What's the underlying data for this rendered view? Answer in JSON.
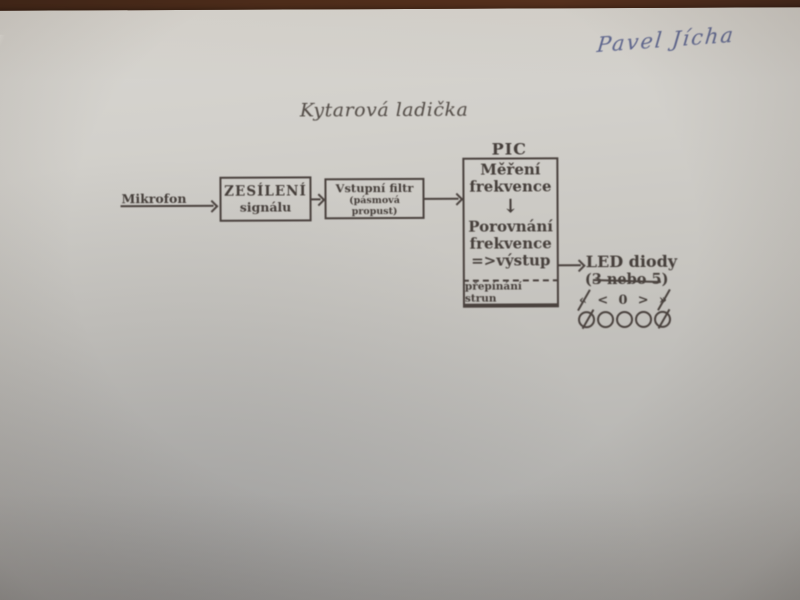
{
  "photo": {
    "handwriting": "Pavel Jícha",
    "title": "Kytarová ladička"
  },
  "diagram": {
    "mikrofon_label": "Mikrofon",
    "amp_box": {
      "line1": "ZESÍLENÍ",
      "line2": "signálu"
    },
    "filter_box": {
      "line1": "Vstupní filtr",
      "line2": "(pásmová propust)"
    },
    "pic": {
      "label": "PIC",
      "step1_line1": "Měření",
      "step1_line2": "frekvence",
      "flow_arrow": "↓",
      "step2_line1": "Porovnání",
      "step2_line2": "frekvence",
      "step2_line3": "=>výstup",
      "footer": "přepínání strun"
    },
    "led": {
      "title": "LED diody",
      "subtitle": "(3 nebo 5)",
      "subtitle_note": "nebo 5 crossed out",
      "symbols": [
        "«",
        "<",
        "0",
        ">",
        "»"
      ],
      "led_count": 5
    }
  },
  "colors": {
    "table_wood": "#4d2c1a",
    "paper": "#c7c5c0",
    "ink": "#453e3a",
    "handwriting_ink": "#5c658f"
  }
}
